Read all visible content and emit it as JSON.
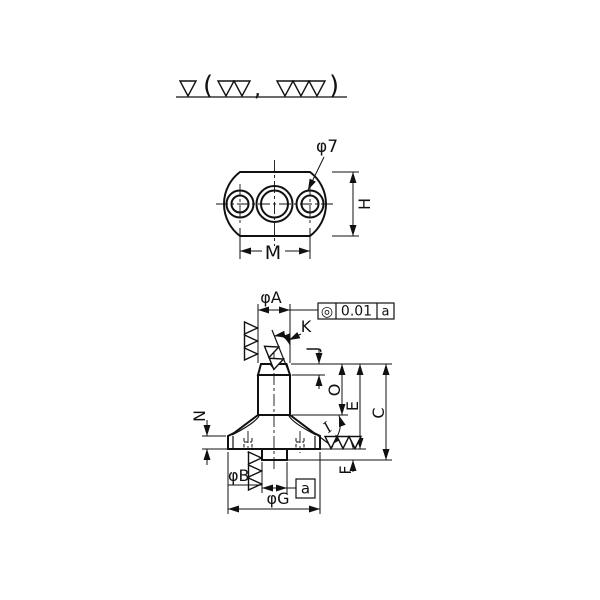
{
  "surface_note": {
    "open_paren": "(",
    "comma": ",",
    "close_paren": ")"
  },
  "top_view": {
    "hole_dia": "φ7",
    "height": "H",
    "hole_spacing": "M"
  },
  "front_view": {
    "dia_top": "φA",
    "tip_angle": "K",
    "chamfer_height": "J",
    "post_height": "O",
    "body_height": "E",
    "total_height": "C",
    "rim_height": "N",
    "cone_angle": "I",
    "boss_height": "F",
    "boss_dia": "φB",
    "flange_dia": "φG",
    "datum_label": "a"
  },
  "tolerance_frame": {
    "symbol": "◎",
    "value": "0.01",
    "datum": "a"
  },
  "colors": {
    "part_fill": "#def2f6",
    "line": "#1a1a1a"
  }
}
